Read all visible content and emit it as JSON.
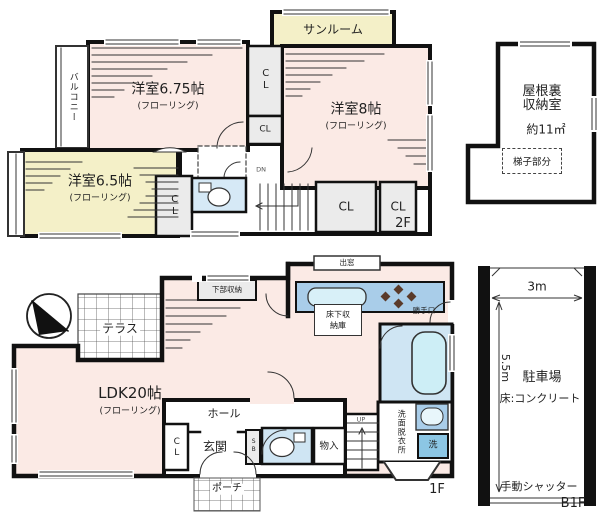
{
  "palette": {
    "wall": "#111111",
    "room_pink": "#fbeae5",
    "room_yellow": "#f4f0c8",
    "closet_grey": "#ebebeb",
    "kitchen_blue": "#a9cde9",
    "bath_blue": "#cfe5f3",
    "tub_blue": "#cdeef6",
    "washer_blue": "#8cc6e4",
    "toilet_room_blue": "#d6e9f6"
  },
  "floor2": {
    "label": "2F",
    "sunroom": "サンルーム",
    "bedroom675": "洋室6.75帖",
    "bedroom8": "洋室8帖",
    "bedroom65": "洋室6.5帖",
    "flooring_note": "(フローリング)",
    "balcony": "バルコニー",
    "closet": "CL",
    "down": "DN"
  },
  "attic": {
    "name_line1": "屋根裏",
    "name_line2": "収納室",
    "area": "約11㎡",
    "ladder": "梯子部分"
  },
  "floor1": {
    "label": "1F",
    "terrace": "テラス",
    "ldk": "LDK20帖",
    "flooring_note": "(フローリング)",
    "lower_storage": "下部収納",
    "bay_window": "出窓",
    "underfloor_line1": "床下収",
    "underfloor_line2": "納庫",
    "back_door": "勝手口",
    "washroom": "洗面脱衣所",
    "washer": "洗",
    "up": "UP",
    "hall": "ホール",
    "entrance": "玄関",
    "shoe_box": "SB",
    "storage": "物入",
    "closet": "CL",
    "porch": "ポーチ"
  },
  "basement": {
    "label": "B1F",
    "width": "3m",
    "depth": "5.5m",
    "name": "駐車場",
    "floor_note": "床:コンクリート",
    "shutter": "手動シャッター"
  }
}
